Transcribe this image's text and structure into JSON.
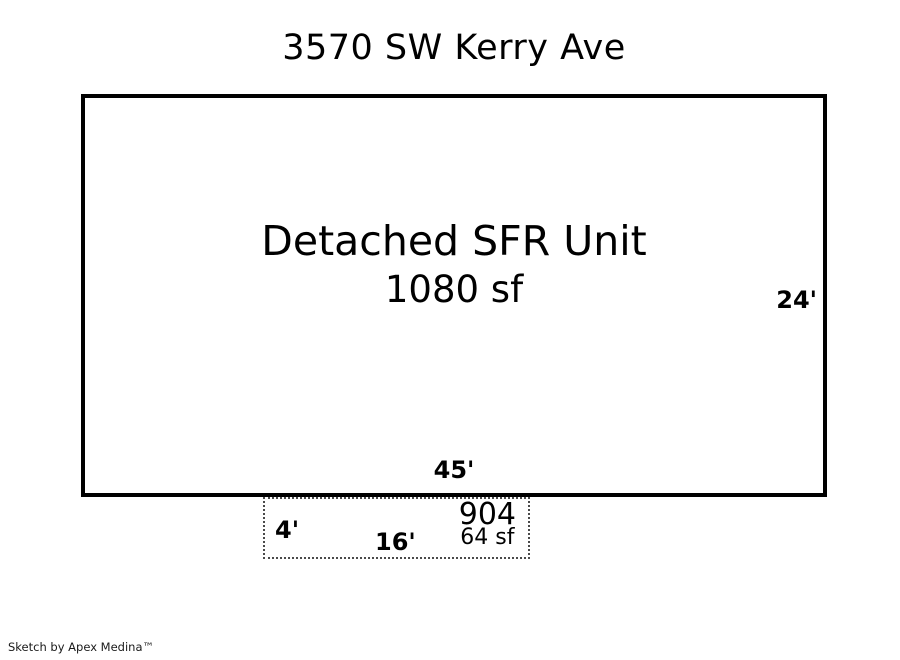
{
  "page": {
    "title": "3570 SW Kerry Ave",
    "footer_credit": "Sketch by Apex Medina™"
  },
  "main_unit": {
    "name": "Detached SFR Unit",
    "area": "1080 sf",
    "dimension_right": "24'",
    "dimension_bottom": "45'"
  },
  "shed": {
    "number": "904",
    "area": "64 sf",
    "dimension_left": "4'",
    "dimension_bottom": "16'"
  },
  "colors": {
    "background": "#ffffff",
    "outline": "#000000",
    "dashed_outline": "#4a4a4a",
    "text": "#000000"
  }
}
